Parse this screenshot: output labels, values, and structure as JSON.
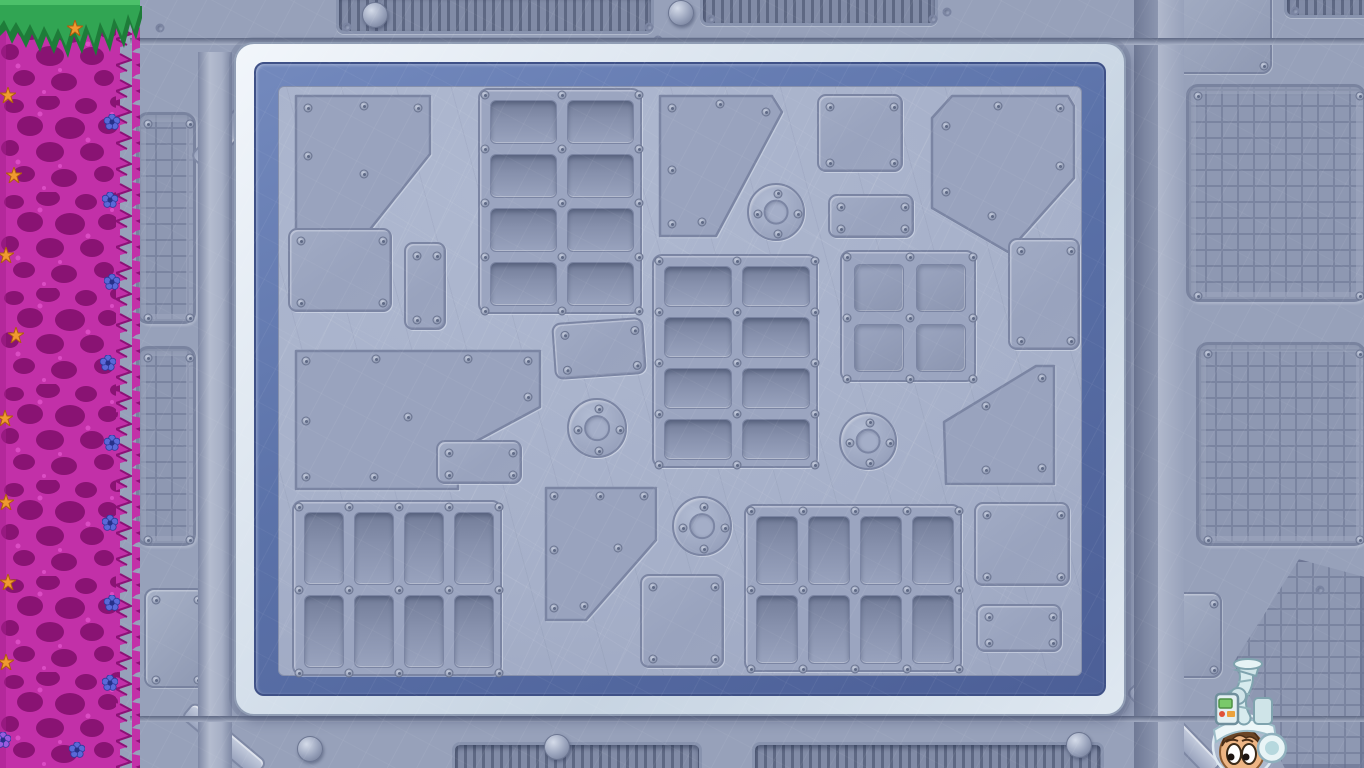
{
  "scene": {
    "width": 1364,
    "height": 768,
    "name": "spaceship-wall-room"
  },
  "colors": {
    "wall": "#97a1ba",
    "wall_dark": "#7f89a6",
    "wall_light": "#b2bace",
    "seam": "#6e7894",
    "panel_face": "#a6b0c9",
    "plate": "#99a3be",
    "plate_edge": "#7b85a3",
    "frame_white": "#e7edf4",
    "frame_shadow": "#c7d4e2",
    "band_blue": "#5d74ab",
    "band_blue_dark": "#44568c",
    "mesh": "#8e98b2",
    "mesh_line": "#7a84a0",
    "grate_dark": "#626c87",
    "coral": "#c230a8",
    "coral_dark": "#84106f",
    "coral_light": "#e85ad2",
    "grass_green": "#31a553",
    "grass_dark": "#1e7c39",
    "star_orange": "#f09a30",
    "flower_blue": "#5a68d8",
    "flower_purple": "#9a5ae0",
    "suit_white": "#e8f4f6",
    "suit_shade": "#8fb0bd",
    "skin": "#edb584",
    "hair": "#6b4526",
    "device_green": "#79c96a",
    "device_red": "#e05238",
    "device_orange": "#eca23c"
  },
  "wall": {
    "meshes": [
      {
        "x": 136,
        "y": 112,
        "w": 60,
        "h": 212
      },
      {
        "x": 136,
        "y": 346,
        "w": 60,
        "h": 200
      },
      {
        "x": 1186,
        "y": 84,
        "w": 180,
        "h": 218
      },
      {
        "x": 1196,
        "y": 342,
        "w": 170,
        "h": 204
      }
    ],
    "hex_mesh": {
      "x": 1232,
      "y": 556,
      "w": 134,
      "h": 214,
      "points": "50 1.5, 100 10, 100 100, 40 100, 1 50"
    },
    "plates": [
      {
        "x": 144,
        "y": 588,
        "w": 62,
        "h": 100
      },
      {
        "x": 1150,
        "y": -20,
        "w": 122,
        "h": 94
      },
      {
        "x": 1158,
        "y": 592,
        "w": 64,
        "h": 86
      }
    ],
    "grates_top": [
      {
        "x": 336,
        "y": -8,
        "w": 318,
        "h": 42
      },
      {
        "x": 700,
        "y": -12,
        "w": 238,
        "h": 38
      },
      {
        "x": 1284,
        "y": -10,
        "w": 96,
        "h": 28
      }
    ],
    "grates_bottom": [
      {
        "x": 452,
        "y": 742,
        "w": 250,
        "h": 40
      },
      {
        "x": 752,
        "y": 742,
        "w": 352,
        "h": 40
      }
    ],
    "domes": [
      {
        "x": 362,
        "y": 2
      },
      {
        "x": 668,
        "y": 0
      },
      {
        "x": 297,
        "y": 736
      },
      {
        "x": 544,
        "y": 734
      },
      {
        "x": 1066,
        "y": 732
      }
    ],
    "holes": [
      [
        333,
        42
      ],
      [
        658,
        40
      ],
      [
        947,
        12
      ],
      [
        160,
        28
      ],
      [
        254,
        714
      ],
      [
        1146,
        690
      ],
      [
        206,
        752
      ],
      [
        1240,
        666
      ],
      [
        1320,
        590
      ]
    ],
    "beams": [
      {
        "cx": 250,
        "cy": 110,
        "len": 150,
        "th": 24,
        "angle": 134
      },
      {
        "cx": 224,
        "cy": 740,
        "len": 96,
        "th": 22,
        "angle": 40
      },
      {
        "cx": 1174,
        "cy": 728,
        "len": 118,
        "th": 22,
        "angle": 46
      }
    ]
  },
  "panel": {
    "frame": {
      "x": 234,
      "y": 42,
      "w": 892,
      "h": 674,
      "band_inset": 20,
      "face_inset": 44
    },
    "plates": [
      {
        "type": "poly",
        "x": 290,
        "y": 90,
        "w": 146,
        "h": 178,
        "points": "6,6 140,6 140,64 54,172 6,172",
        "rivets": [
          [
            18,
            18
          ],
          [
            74,
            16
          ],
          [
            128,
            18
          ],
          [
            18,
            66
          ],
          [
            74,
            84
          ],
          [
            18,
            158
          ]
        ]
      },
      {
        "type": "vents",
        "x": 478,
        "y": 88,
        "w": 164,
        "h": 226,
        "cols": 2,
        "rows": 4
      },
      {
        "type": "poly",
        "x": 654,
        "y": 90,
        "w": 134,
        "h": 152,
        "points": "6,6 118,6 128,22 62,146 6,146",
        "rivets": [
          [
            18,
            18
          ],
          [
            66,
            14
          ],
          [
            112,
            22
          ],
          [
            18,
            80
          ],
          [
            18,
            134
          ],
          [
            48,
            132
          ]
        ]
      },
      {
        "type": "porthole",
        "cx": 776,
        "cy": 212,
        "r": 29
      },
      {
        "type": "rect",
        "x": 817,
        "y": 94,
        "w": 86,
        "h": 78
      },
      {
        "type": "rect",
        "x": 828,
        "y": 194,
        "w": 86,
        "h": 44
      },
      {
        "type": "poly",
        "x": 926,
        "y": 90,
        "w": 154,
        "h": 166,
        "points": "6,28 26,6 142,6 148,16 148,88 82,162 6,118",
        "rivets": [
          [
            20,
            36
          ],
          [
            72,
            16
          ],
          [
            134,
            18
          ],
          [
            134,
            76
          ],
          [
            20,
            102
          ],
          [
            66,
            126
          ]
        ]
      },
      {
        "type": "rect",
        "x": 1008,
        "y": 238,
        "w": 72,
        "h": 112
      },
      {
        "type": "rect",
        "x": 288,
        "y": 228,
        "w": 104,
        "h": 84
      },
      {
        "type": "rect",
        "x": 404,
        "y": 242,
        "w": 42,
        "h": 88,
        "rivets": [
          [
            11,
            12
          ],
          [
            31,
            12
          ],
          [
            11,
            76
          ],
          [
            31,
            76
          ]
        ]
      },
      {
        "type": "poly",
        "x": 290,
        "y": 345,
        "w": 256,
        "h": 150,
        "points": "6,6 250,6 250,62 168,106 168,144 6,144",
        "rivets": [
          [
            16,
            16
          ],
          [
            86,
            14
          ],
          [
            178,
            14
          ],
          [
            238,
            16
          ],
          [
            238,
            52
          ],
          [
            16,
            76
          ],
          [
            118,
            72
          ],
          [
            16,
            132
          ],
          [
            84,
            132
          ],
          [
            152,
            130
          ]
        ]
      },
      {
        "type": "rect",
        "x": 553,
        "y": 320,
        "w": 92,
        "h": 57,
        "angle": -4
      },
      {
        "type": "porthole",
        "cx": 597,
        "cy": 428,
        "r": 30
      },
      {
        "type": "vents",
        "x": 652,
        "y": 254,
        "w": 166,
        "h": 214,
        "cols": 2,
        "rows": 4
      },
      {
        "type": "vents",
        "x": 840,
        "y": 250,
        "w": 136,
        "h": 132,
        "cols": 2,
        "rows": 2,
        "win": true
      },
      {
        "type": "porthole",
        "cx": 868,
        "cy": 441,
        "r": 29
      },
      {
        "type": "rect",
        "x": 436,
        "y": 440,
        "w": 86,
        "h": 44
      },
      {
        "type": "poly",
        "x": 938,
        "y": 360,
        "w": 122,
        "h": 130,
        "points": "6,62 98,6 116,6 116,124 8,124",
        "rivets": [
          [
            48,
            46
          ],
          [
            104,
            18
          ],
          [
            48,
            110
          ],
          [
            104,
            108
          ]
        ]
      },
      {
        "type": "poly",
        "x": 540,
        "y": 482,
        "w": 122,
        "h": 142,
        "points": "6,6 116,6 116,58 46,138 6,138",
        "rivets": [
          [
            14,
            14
          ],
          [
            60,
            14
          ],
          [
            104,
            14
          ],
          [
            14,
            68
          ],
          [
            78,
            66
          ],
          [
            14,
            126
          ],
          [
            44,
            124
          ]
        ]
      },
      {
        "type": "porthole",
        "cx": 702,
        "cy": 526,
        "r": 30
      },
      {
        "type": "rect",
        "x": 640,
        "y": 574,
        "w": 84,
        "h": 94
      },
      {
        "type": "vents",
        "x": 292,
        "y": 500,
        "w": 210,
        "h": 176,
        "cols": 4,
        "rows": 2
      },
      {
        "type": "vents",
        "x": 744,
        "y": 504,
        "w": 218,
        "h": 168,
        "cols": 4,
        "rows": 2
      },
      {
        "type": "rect",
        "x": 974,
        "y": 502,
        "w": 96,
        "h": 84
      },
      {
        "type": "rect",
        "x": 976,
        "y": 604,
        "w": 86,
        "h": 48
      }
    ]
  },
  "coral": {
    "x": 0,
    "w": 140,
    "flowers": [
      {
        "t": "star",
        "x": 75,
        "y": 28
      },
      {
        "t": "star",
        "x": 8,
        "y": 95
      },
      {
        "t": "star",
        "x": 14,
        "y": 175
      },
      {
        "t": "star",
        "x": 6,
        "y": 255
      },
      {
        "t": "star",
        "x": 16,
        "y": 335
      },
      {
        "t": "star",
        "x": 5,
        "y": 418
      },
      {
        "t": "star",
        "x": 6,
        "y": 502
      },
      {
        "t": "star",
        "x": 8,
        "y": 582
      },
      {
        "t": "star",
        "x": 6,
        "y": 662
      },
      {
        "t": "flower",
        "x": 112,
        "y": 122
      },
      {
        "t": "flower",
        "x": 110,
        "y": 200
      },
      {
        "t": "flower",
        "x": 112,
        "y": 282
      },
      {
        "t": "flower",
        "x": 108,
        "y": 363
      },
      {
        "t": "flower",
        "x": 112,
        "y": 443
      },
      {
        "t": "flower",
        "x": 110,
        "y": 523
      },
      {
        "t": "flower",
        "x": 112,
        "y": 603
      },
      {
        "t": "flower",
        "x": 110,
        "y": 683
      },
      {
        "t": "flower",
        "x": 77,
        "y": 750
      },
      {
        "t": "flower_purple",
        "x": 3,
        "y": 740
      }
    ]
  },
  "character": {
    "name": "space-helmet-kid-sprite",
    "x": 1202,
    "y": 654,
    "w": 104,
    "h": 114
  }
}
